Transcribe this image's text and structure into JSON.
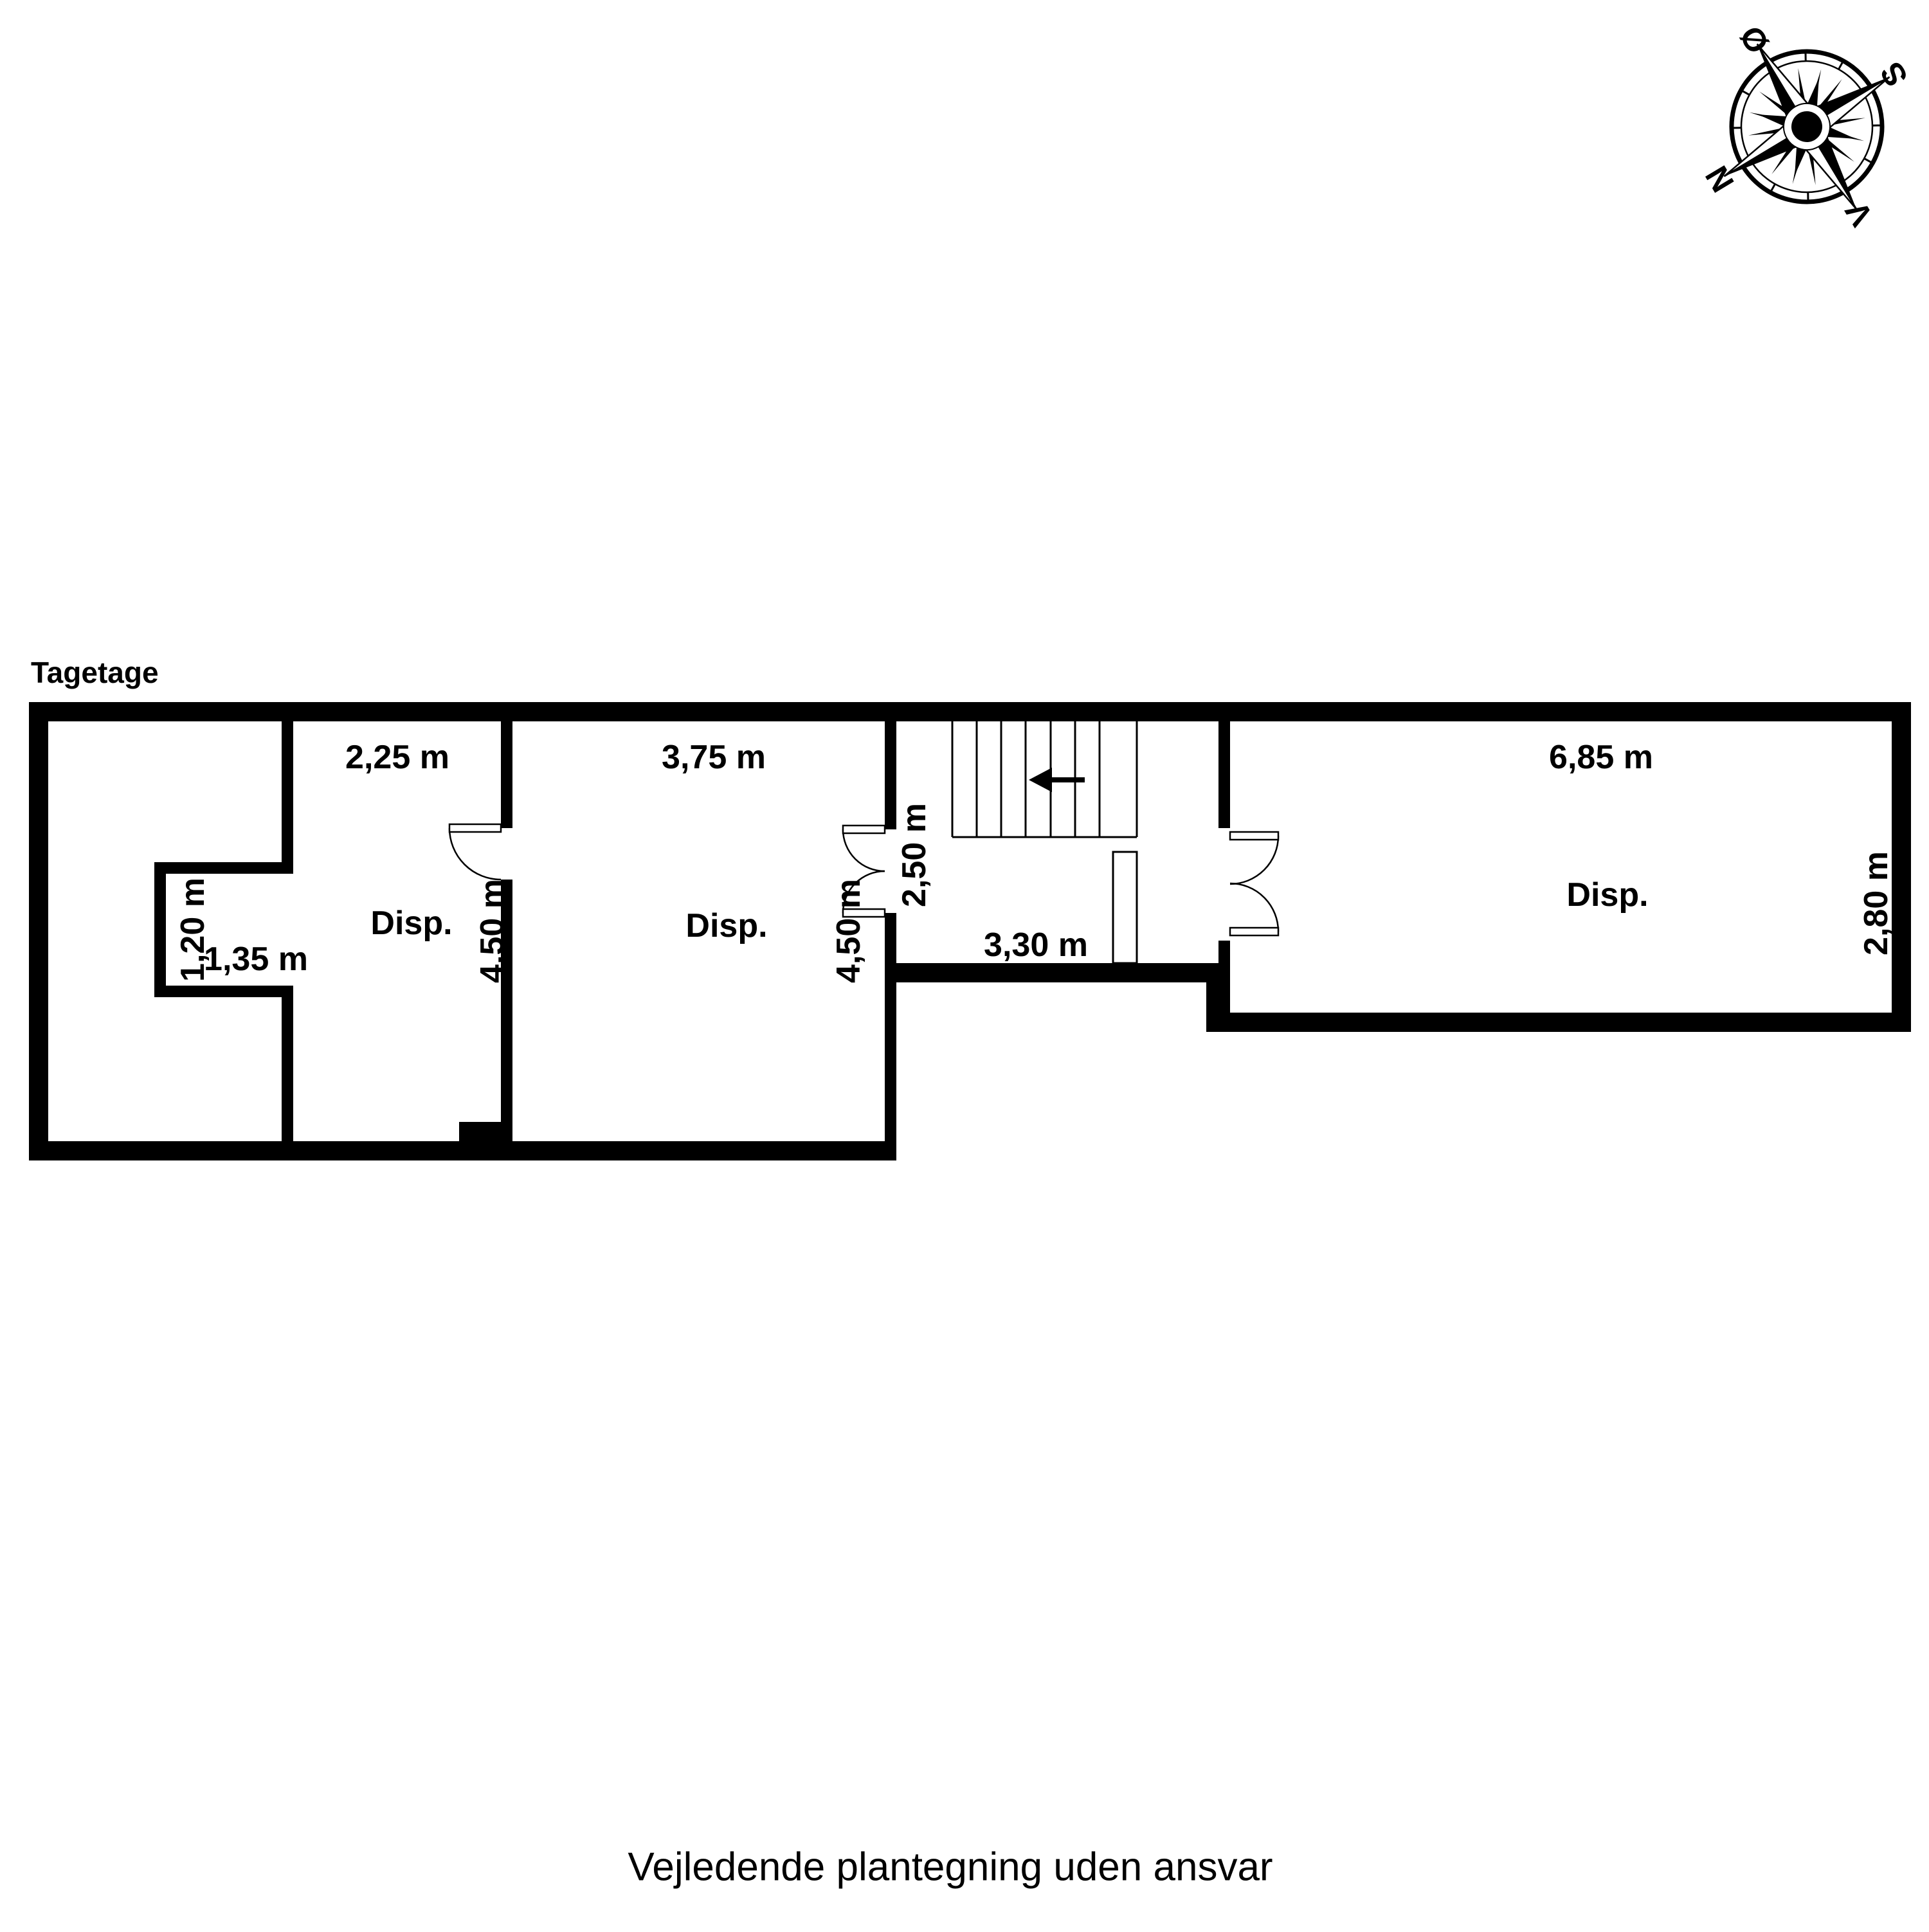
{
  "floor_label": "Tagetage",
  "caption": "Vejledende plantegning uden ansvar",
  "compass": {
    "north": "N",
    "south": "S",
    "east": "Ø",
    "west": "V"
  },
  "room_labels": {
    "room_b": "Disp.",
    "room_c": "Disp.",
    "room_d": "Disp."
  },
  "dims": {
    "room_b_width": "2,25 m",
    "room_b_depth": "4,50 m",
    "room_c_width": "3,75 m",
    "room_c_depth": "4,50 m",
    "room_d_width": "6,85 m",
    "room_d_depth": "2,80 m",
    "hall_width": "3,30 m",
    "hall_depth": "2,50 m",
    "alcove_width": "1,35 m",
    "alcove_depth": "1,20 m"
  }
}
